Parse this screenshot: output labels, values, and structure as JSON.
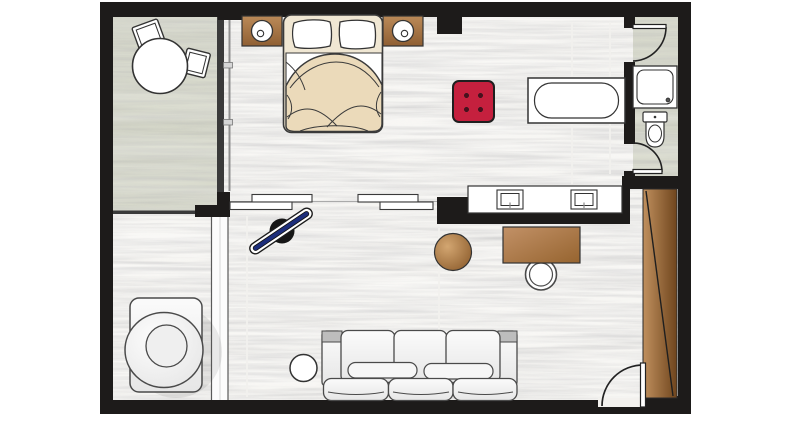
{
  "meta": {
    "title": "hotel-guest-room-floor-plan",
    "canvas": {
      "width": 800,
      "height": 421
    }
  },
  "palette": {
    "wall": "#1d1b1a",
    "floor": "#f6f5f2",
    "sage": "#d4d6c7",
    "outline": "#333333",
    "white_item": "#ffffff",
    "soft_light": "#fbfbfb",
    "soft_dark": "#e6e6e6",
    "pouf": "#c5203e",
    "pouf_dot": "#4d0d1c",
    "nightstand_light": "#bb8a58",
    "nightstand_dark": "#8f5f33",
    "desk_light": "#c29167",
    "desk_dark": "#96642f",
    "table_light": "#d3a671",
    "table_dark": "#8a5a2a",
    "wardrobe_light": "#c0905e",
    "wardrobe_dark": "#6f451d",
    "board_stripe": "#1d2e7b",
    "iron": "#161616",
    "bed_base": "#f0e7d3",
    "duvet": "#ebdaba",
    "partition": "#fcfcfc"
  },
  "rooms": [
    {
      "id": "terrace",
      "name": "terrace-with-table-and-chairs"
    },
    {
      "id": "bedroom-living",
      "name": "open-plan-bedroom-living-area"
    },
    {
      "id": "shower-wc",
      "name": "shower-and-wc-compartment"
    },
    {
      "id": "entrance",
      "name": "entrance-with-wardrobe"
    }
  ],
  "items": [
    "terrace-round-table",
    "terrace-chair x2",
    "double-bed",
    "pillow x2",
    "nightstand-with-lamp x2",
    "red-pouf",
    "bathtub",
    "double-vanity-sinks",
    "sliding-panel x4",
    "ironing-board-with-iron",
    "desk",
    "desk-chair",
    "round-side-table",
    "three-seat-sofa",
    "sofa-side-table",
    "swivel-armchair",
    "shower-tray",
    "toilet",
    "wardrobe",
    "entry-door",
    "bathroom-door x2"
  ]
}
